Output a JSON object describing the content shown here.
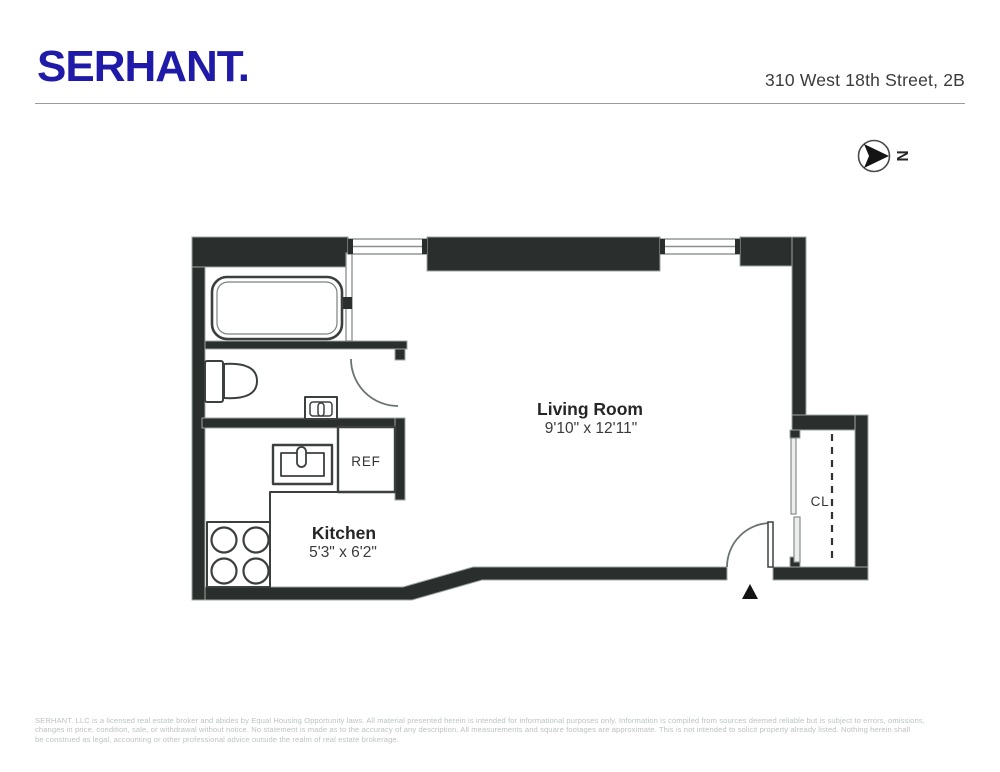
{
  "header": {
    "logo": "SERHANT.",
    "address": "310 West 18th Street, 2B"
  },
  "compass": {
    "north_label": "N"
  },
  "floorplan": {
    "living_room": {
      "name": "Living Room",
      "dims": "9'10\" x 12'11\""
    },
    "kitchen": {
      "name": "Kitchen",
      "dims": "5'3\" x 6'2\""
    },
    "refrigerator_label": "REF",
    "closet_label": "CL"
  },
  "footer": {
    "lines": [
      "SERHANT. LLC is a licensed real estate broker and abides by Equal Housing Opportunity laws. All material presented herein is intended for informational purposes only. Information is compiled from sources deemed reliable but is subject to errors, omissions,",
      "changes in price, condition, sale, or withdrawal without notice. No statement is made as to the accuracy of any description. All measurements and square footages are approximate. This is not intended to solicit property already listed. Nothing herein shall",
      "be construed as legal, accounting or other professional advice outside the realm of real estate brokerage."
    ]
  },
  "colors": {
    "brand_blue": "#1f1aa7",
    "wall": "#2a2e2c",
    "wall_outline": "#9ea5a1",
    "fixture_line": "#3b403e"
  }
}
